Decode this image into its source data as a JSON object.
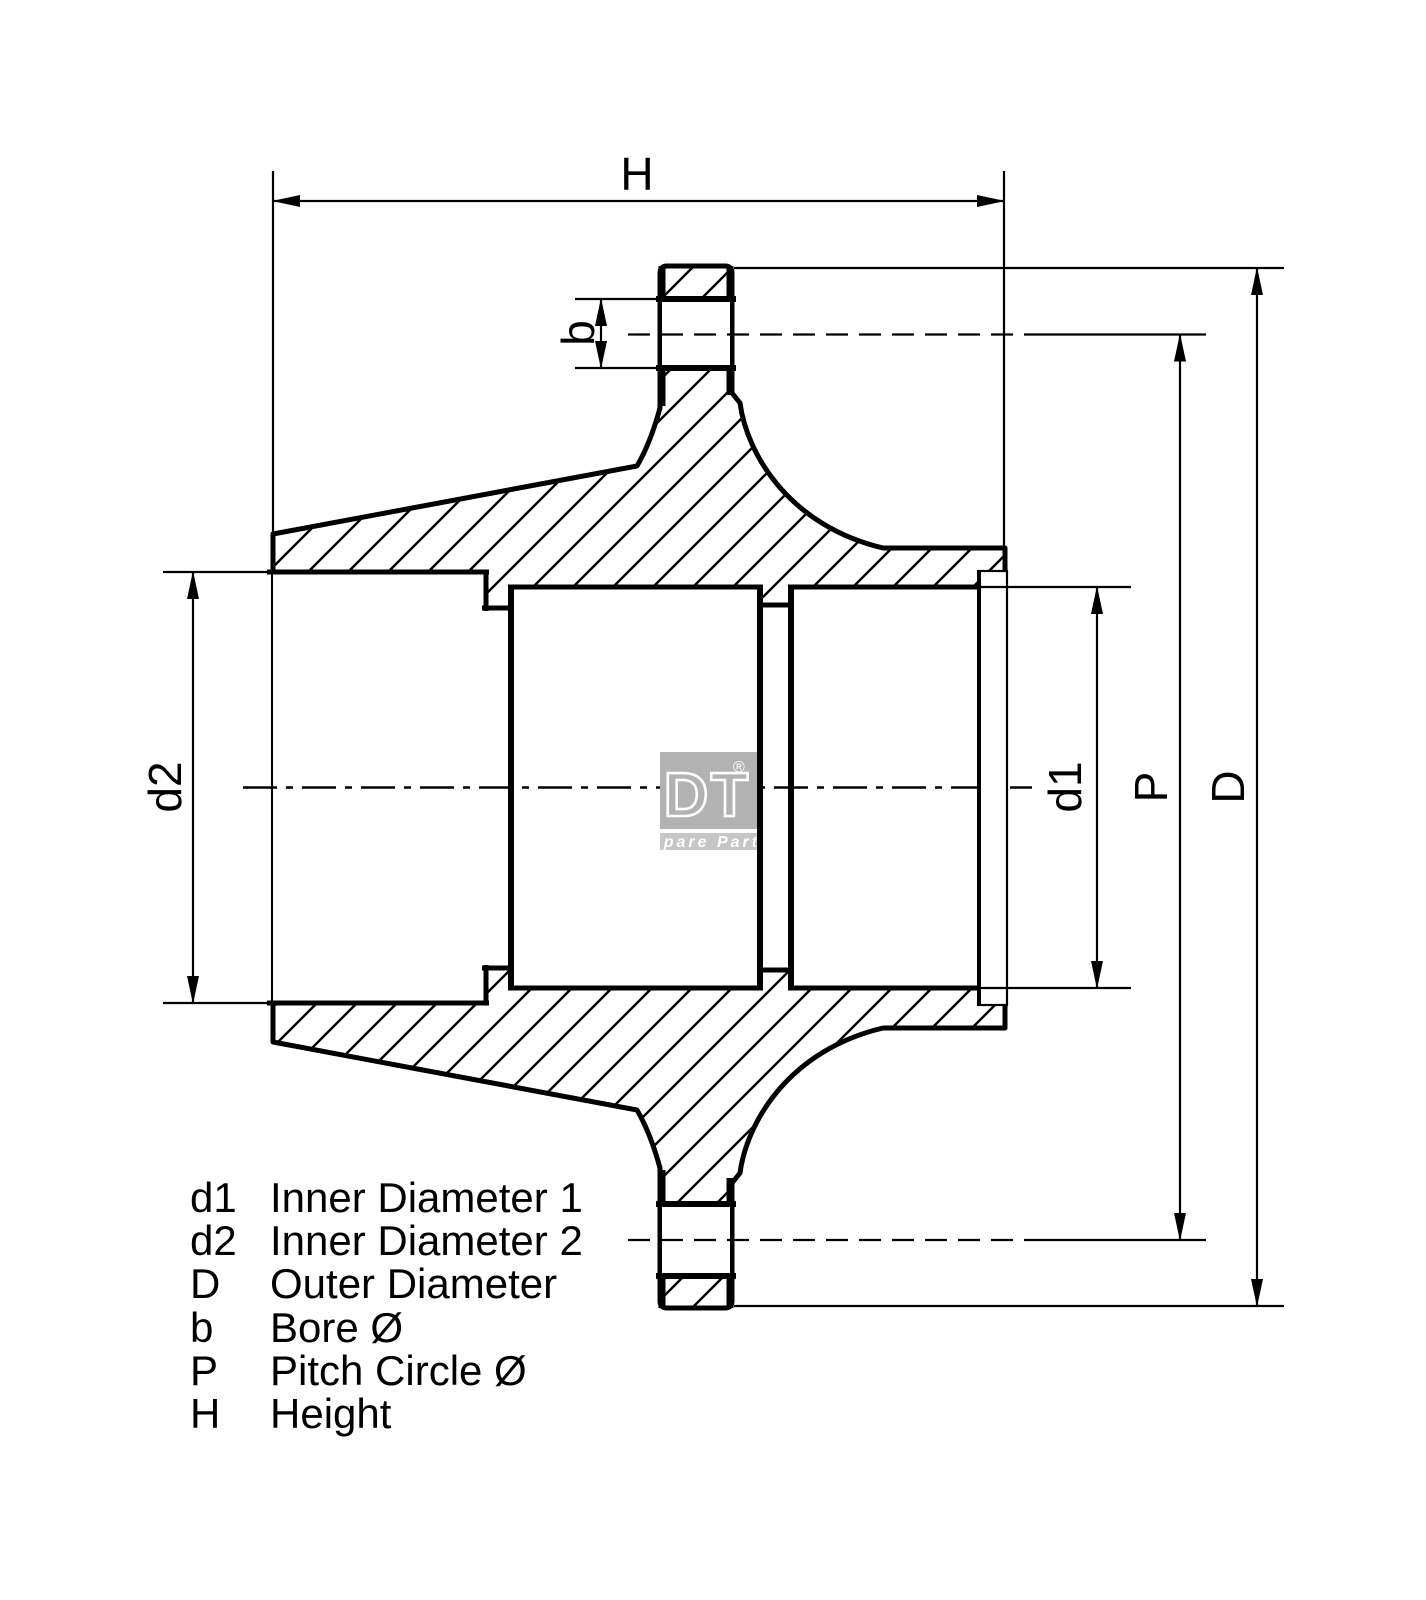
{
  "colors": {
    "line": "#000000",
    "background": "#ffffff",
    "logo_box": "#b2b2b2",
    "logo_strip": "#c6c6c6",
    "logo_text": "#ffffff"
  },
  "dimensions": {
    "h": {
      "label": "H"
    },
    "b": {
      "label": "b"
    },
    "d1": {
      "label": "d1"
    },
    "d2": {
      "label": "d2"
    },
    "p": {
      "label": "P"
    },
    "d": {
      "label": "D"
    }
  },
  "legend": {
    "items": [
      {
        "symbol": "d1",
        "description": "Inner Diameter 1"
      },
      {
        "symbol": "d2",
        "description": "Inner Diameter 2"
      },
      {
        "symbol": "D",
        "description": "Outer Diameter"
      },
      {
        "symbol": "b",
        "description": "Bore Ø"
      },
      {
        "symbol": "P",
        "description": "Pitch Circle Ø"
      },
      {
        "symbol": "H",
        "description": "Height"
      }
    ]
  },
  "logo": {
    "brand": "DT",
    "registered": "®",
    "tagline": "Spare Parts"
  }
}
